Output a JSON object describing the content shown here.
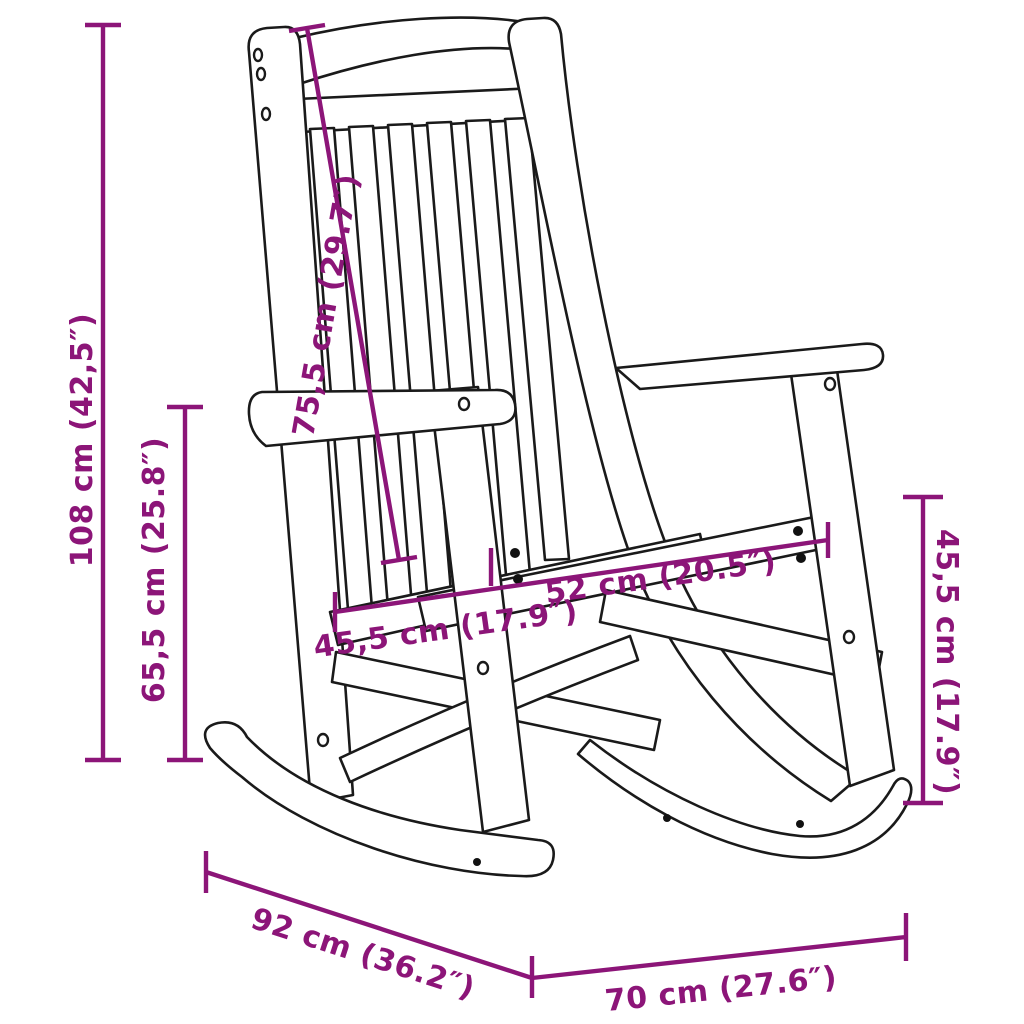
{
  "diagram": {
    "subject": "wooden rocking chair dimension drawing",
    "style": {
      "background": "#ffffff",
      "outline_color": "#1a1a1a",
      "dimension_color": "#8C1578"
    },
    "dimensions": {
      "overall_height": "108 cm (42,5″)",
      "armrest_height": "65,5 cm (25.8″)",
      "backrest_length": "75,5 cm (29.7″)",
      "seat_depth": "45,5 cm (17.9″)",
      "seat_width": "52 cm (20.5″)",
      "side_height": "45,5 cm (17.9″)",
      "rocker_depth": "92 cm (36.2″)",
      "overall_width": "70 cm (27.6″)"
    }
  }
}
